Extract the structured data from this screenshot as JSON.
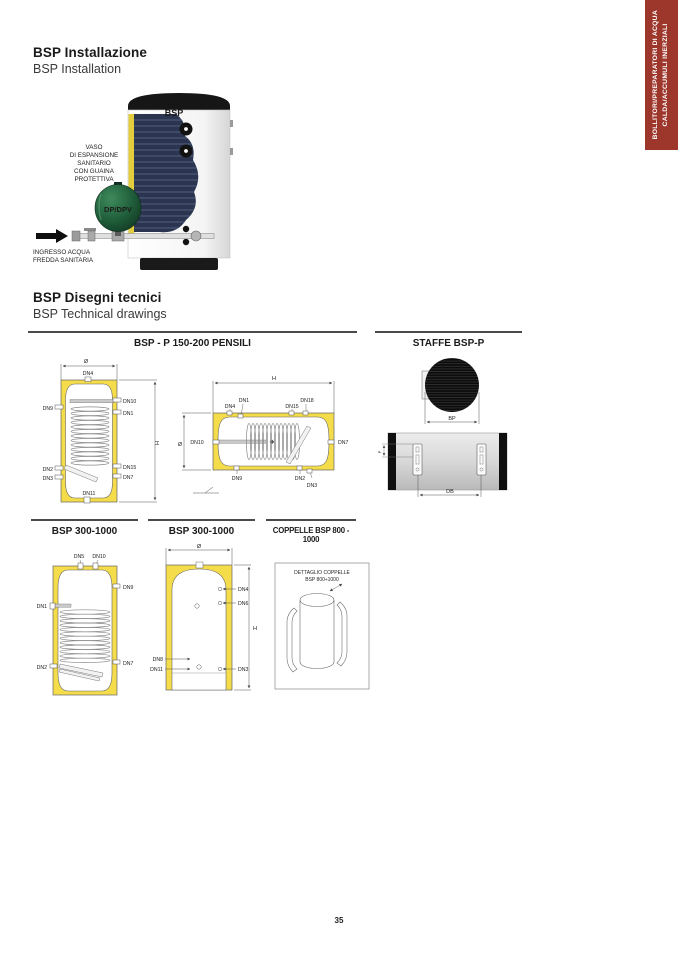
{
  "colors": {
    "accent_red": "#9D372C",
    "insulation_yellow": "#F4DC4A",
    "cutaway_navy": "#2B3550",
    "vessel_green": "#2F7A4D"
  },
  "sidebar_tab": {
    "line1": "BOLLITORI/PREPARATORI DI ACQUA",
    "line2": "CALDA/ACCUMULI INERZIALI"
  },
  "installation": {
    "title_it": "BSP Installazione",
    "title_en": "BSP Installation",
    "tank_label": "BSP",
    "vessel_label": "DP/DPV",
    "expansion_note": [
      "VASO",
      "DI ESPANSIONE",
      "SANITARIO",
      "CON GUAINA",
      "PROTETTIVA"
    ],
    "inlet_note": [
      "INGRESSO ACQUA",
      "FREDDA SANITARIA"
    ]
  },
  "technical": {
    "title_it": "BSP Disegni tecnici",
    "title_en": "BSP Technical drawings",
    "headers": {
      "pensili": "BSP - P 150-200 PENSILI",
      "staffe": "STAFFE BSP-P",
      "bsp300_front": "BSP 300-1000",
      "bsp300_side": "BSP 300-1000",
      "coppelle": "COPPELLE BSP 800 - 1000"
    },
    "d1": {
      "dia": "Ø",
      "h": "H",
      "dn4": "DN4",
      "dn9": "DN9",
      "dn10": "DN10",
      "dn1": "DN1",
      "dn2": "DN2",
      "dn3": "DN3",
      "dn15": "DN15",
      "dn7": "DN7",
      "dn11": "DN11"
    },
    "d2": {
      "h": "H",
      "dia": "Ø",
      "dn10": "DN10",
      "dn4": "DN4",
      "dn1": "DN1",
      "dn15": "DN15",
      "dn18": "DN18",
      "dn7": "DN7",
      "dn9": "DN9",
      "dn2": "DN2",
      "dn3": "DN3"
    },
    "staffe": {
      "bp": "BP",
      "db": "DB",
      "p": "P"
    },
    "d4": {
      "dn5": "DN5",
      "dn10": "DN10",
      "dn9": "DN9",
      "dn1": "DN1",
      "dn7": "DN7",
      "dn2": "DN2"
    },
    "d5": {
      "dia": "Ø",
      "dn4": "DN4",
      "dn6": "DN6",
      "h": "H",
      "dn8": "DN8",
      "dn11": "DN11",
      "dn3": "DN3"
    },
    "coppelle_detail": {
      "line1": "DETTAGLIO COPPELLE",
      "line2": "BSP 800÷1000"
    }
  },
  "footer": {
    "page_number": "35"
  }
}
